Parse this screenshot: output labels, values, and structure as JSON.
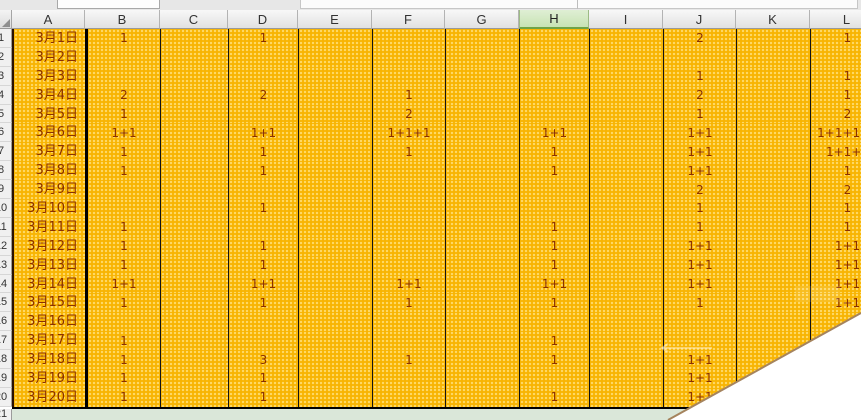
{
  "app": {
    "kind": "spreadsheet",
    "top_bar": {
      "name_box_fragment": "",
      "formula_bar_fragment": ""
    }
  },
  "colors": {
    "cell_fill_orange": "#F8B402",
    "cell_text_brown": "#8B3000",
    "active_header_green": "#C8E3B4",
    "active_header_border": "#6FA348",
    "summary_row_green": "#DAE7D9",
    "grid_line_black": "#141414",
    "tear_edge_brown": "#A5845E"
  },
  "sheet": {
    "column_headers": [
      "A",
      "B",
      "C",
      "D",
      "E",
      "F",
      "G",
      "H",
      "I",
      "J",
      "K",
      "L"
    ],
    "highlighted_column": "H",
    "rows": [
      {
        "n": "1",
        "date": "3月1日",
        "cells": {
          "B": "1",
          "D": "1",
          "J": "2",
          "L": "1"
        }
      },
      {
        "n": "2",
        "date": "3月2日",
        "cells": {}
      },
      {
        "n": "3",
        "date": "3月3日",
        "cells": {
          "J": "1",
          "L": "1"
        }
      },
      {
        "n": "4",
        "date": "3月4日",
        "cells": {
          "B": "2",
          "D": "2",
          "F": "1",
          "J": "2",
          "L": "1"
        }
      },
      {
        "n": "5",
        "date": "3月5日",
        "cells": {
          "B": "1",
          "F": "2",
          "J": "1",
          "L": "2"
        }
      },
      {
        "n": "6",
        "date": "3月6日",
        "cells": {
          "B": "1+1",
          "D": "1+1",
          "F": "1+1+1",
          "H": "1+1",
          "J": "1+1",
          "L": "1+1+1+1"
        }
      },
      {
        "n": "7",
        "date": "3月7日",
        "cells": {
          "B": "1",
          "D": "1",
          "F": "1",
          "H": "1",
          "J": "1+1",
          "L": "1+1+1"
        }
      },
      {
        "n": "8",
        "date": "3月8日",
        "cells": {
          "B": "1",
          "D": "1",
          "H": "1",
          "J": "1+1",
          "L": "1"
        }
      },
      {
        "n": "9",
        "date": "3月9日",
        "cells": {
          "J": "2",
          "L": "2"
        }
      },
      {
        "n": "10",
        "date": "3月10日",
        "cells": {
          "D": "1",
          "J": "1",
          "L": "1"
        }
      },
      {
        "n": "11",
        "date": "3月11日",
        "cells": {
          "B": "1",
          "H": "1",
          "J": "1",
          "L": "1"
        }
      },
      {
        "n": "12",
        "date": "3月12日",
        "cells": {
          "B": "1",
          "D": "1",
          "H": "1",
          "J": "1+1",
          "L": "1+1"
        }
      },
      {
        "n": "13",
        "date": "3月13日",
        "cells": {
          "B": "1",
          "D": "1",
          "H": "1",
          "J": "1+1",
          "L": "1+1"
        }
      },
      {
        "n": "14",
        "date": "3月14日",
        "cells": {
          "B": "1+1",
          "D": "1+1",
          "F": "1+1",
          "H": "1+1",
          "J": "1+1",
          "L": "1+1"
        }
      },
      {
        "n": "15",
        "date": "3月15日",
        "cells": {
          "B": "1",
          "D": "1",
          "F": "1",
          "H": "1",
          "J": "1",
          "L": "1+1"
        }
      },
      {
        "n": "16",
        "date": "3月16日",
        "cells": {}
      },
      {
        "n": "17",
        "date": "3月17日",
        "cells": {
          "B": "1",
          "H": "1"
        }
      },
      {
        "n": "18",
        "date": "3月18日",
        "cells": {
          "B": "1",
          "D": "3",
          "F": "1",
          "H": "1",
          "J": "1+1"
        }
      },
      {
        "n": "19",
        "date": "3月19日",
        "cells": {
          "B": "1",
          "D": "1",
          "J": "1+1"
        }
      },
      {
        "n": "20",
        "date": "3月20日",
        "cells": {
          "B": "1",
          "D": "1",
          "H": "1",
          "J": "1+1"
        }
      }
    ],
    "bottom_row": {
      "n": "21"
    }
  }
}
